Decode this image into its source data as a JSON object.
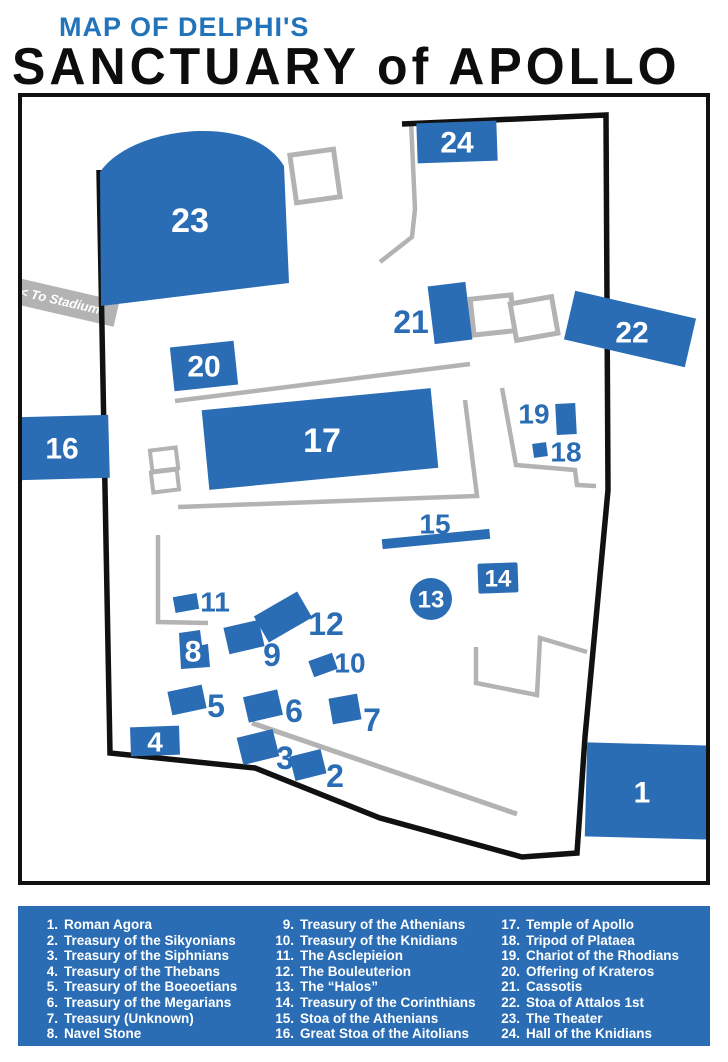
{
  "title": {
    "kicker": "MAP OF DELPHI'S",
    "main": "SANCTUARY of APOLLO"
  },
  "map": {
    "stadium_sign": "< To Stadium",
    "labels": {
      "n1": "1",
      "n2": "2",
      "n3": "3",
      "n4": "4",
      "n5": "5",
      "n6": "6",
      "n7": "7",
      "n8": "8",
      "n9": "9",
      "n10": "10",
      "n11": "11",
      "n12": "12",
      "n13": "13",
      "n14": "14",
      "n15": "15",
      "n16": "16",
      "n17": "17",
      "n18": "18",
      "n19": "19",
      "n20": "20",
      "n21": "21",
      "n22": "22",
      "n23": "23",
      "n24": "24"
    }
  },
  "legend": {
    "columns": [
      {
        "items": [
          {
            "num": "1.",
            "label": "Roman Agora"
          },
          {
            "num": "2.",
            "label": "Treasury of the Sikyonians"
          },
          {
            "num": "3.",
            "label": "Treasury of the Siphnians"
          },
          {
            "num": "4.",
            "label": "Treasury of the Thebans"
          },
          {
            "num": "5.",
            "label": "Treasury of the Boeoetians"
          },
          {
            "num": "6.",
            "label": "Treasury of the Megarians"
          },
          {
            "num": "7.",
            "label": "Treasury (Unknown)"
          },
          {
            "num": "8.",
            "label": "Navel Stone"
          }
        ]
      },
      {
        "items": [
          {
            "num": "9.",
            "label": "Treasury of the Athenians"
          },
          {
            "num": "10.",
            "label": "Treasury of the Knidians"
          },
          {
            "num": "11.",
            "label": "The Asclepieion"
          },
          {
            "num": "12.",
            "label": "The Bouleuterion"
          },
          {
            "num": "13.",
            "label": "The “Halos”"
          },
          {
            "num": "14.",
            "label": "Treasury of the Corinthians"
          },
          {
            "num": "15.",
            "label": "Stoa of the Athenians"
          },
          {
            "num": "16.",
            "label": "Great Stoa of the Aitolians"
          }
        ]
      },
      {
        "items": [
          {
            "num": "17.",
            "label": "Temple of Apollo"
          },
          {
            "num": "18.",
            "label": "Tripod of Plataea"
          },
          {
            "num": "19.",
            "label": "Chariot of the Rhodians"
          },
          {
            "num": "20.",
            "label": "Offering of Krateros"
          },
          {
            "num": "21.",
            "label": "Cassotis"
          },
          {
            "num": "22.",
            "label": "Stoa of Attalos 1st"
          },
          {
            "num": "23.",
            "label": "The Theater"
          },
          {
            "num": "24.",
            "label": "Hall of the Knidians"
          }
        ]
      }
    ]
  },
  "colors": {
    "site_blue": "#2a6db5",
    "title_blue": "#2273b9",
    "path_gray": "#b3b3b3",
    "boundary_black": "#111111"
  }
}
